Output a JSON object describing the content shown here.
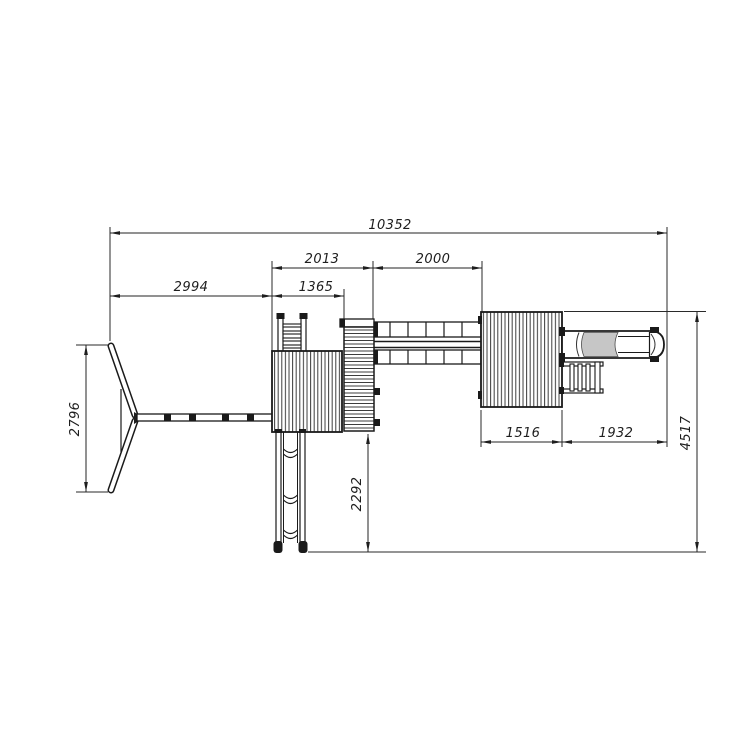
{
  "drawing": {
    "kind": "technical-top-view-playset",
    "colors": {
      "background": "#ffffff",
      "line": "#1a1a1a",
      "dimension": "#232323",
      "tube_shade": "#c6c6c6"
    },
    "dims": {
      "total_width": "10352",
      "swing_section_width": "2994",
      "tower_section_width": "2013",
      "left_platform_width": "1365",
      "bridge_width": "2000",
      "right_platform_width": "1516",
      "tube_slide_length": "1932",
      "swing_frame_depth": "2796",
      "straight_slide_length": "2292",
      "overall_depth": "4517"
    }
  }
}
